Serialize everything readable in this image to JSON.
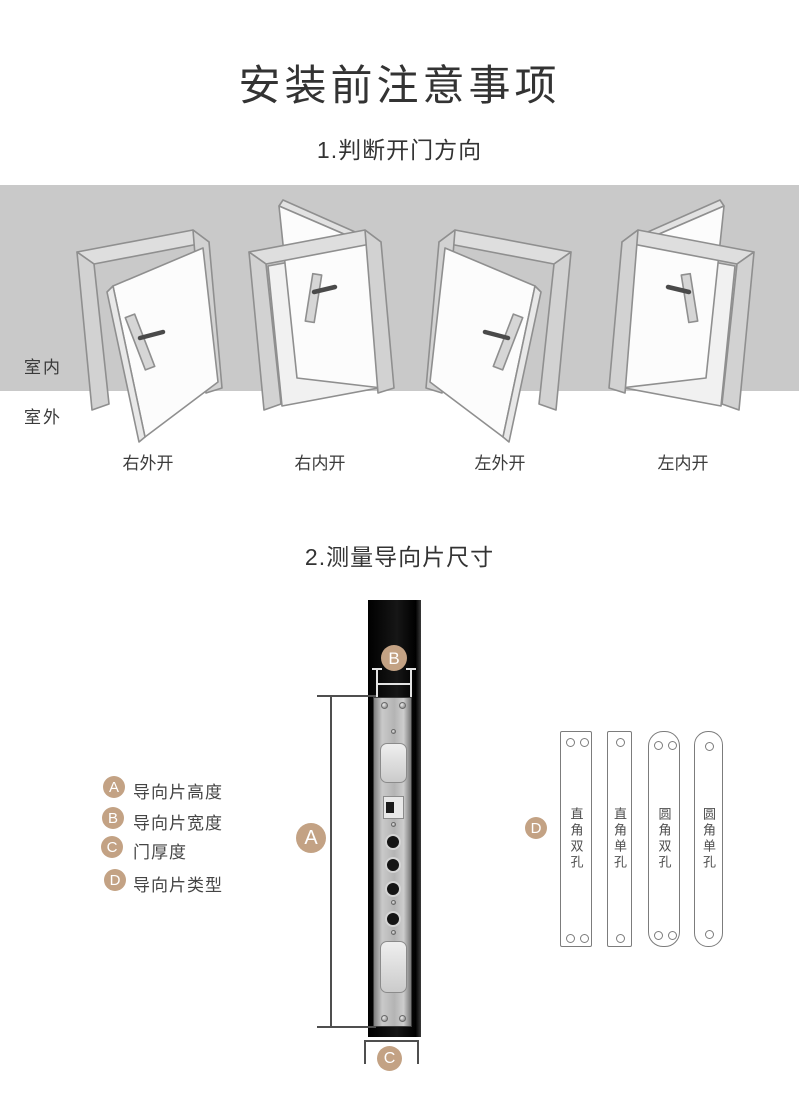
{
  "header": {
    "title": "安装前注意事项"
  },
  "section1": {
    "heading": "1.判断开门方向",
    "indoor_label": "室内",
    "outdoor_label": "室外",
    "doors": [
      {
        "label": "右外开",
        "type": "right-outward"
      },
      {
        "label": "右内开",
        "type": "right-inward"
      },
      {
        "label": "左外开",
        "type": "left-outward"
      },
      {
        "label": "左内开",
        "type": "left-inward"
      }
    ]
  },
  "section2": {
    "heading": "2.测量导向片尺寸",
    "legend": [
      {
        "key": "A",
        "label": "导向片高度"
      },
      {
        "key": "B",
        "label": "导向片宽度"
      },
      {
        "key": "C",
        "label": "门厚度"
      },
      {
        "key": "D",
        "label": "导向片类型"
      }
    ],
    "plates": [
      {
        "label": "直角双孔",
        "corners": "square",
        "holes": 2
      },
      {
        "label": "直角单孔",
        "corners": "square",
        "holes": 1
      },
      {
        "label": "圆角双孔",
        "corners": "round",
        "holes": 2
      },
      {
        "label": "圆角单孔",
        "corners": "round",
        "holes": 1
      }
    ]
  },
  "colors": {
    "accent": "#c3a284",
    "band": "#c9c9c9",
    "text": "#3c3c3c"
  }
}
